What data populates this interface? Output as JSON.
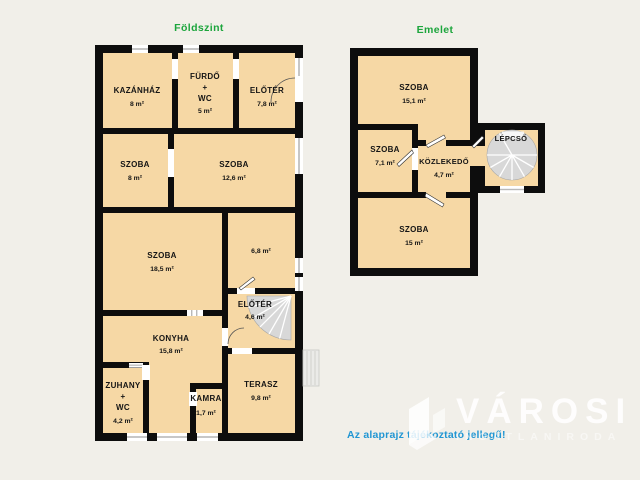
{
  "titles": {
    "ground": "Földszint",
    "upper": "Emelet"
  },
  "note": "Az alaprajz tájékoztató jellegű!",
  "watermark": {
    "brand": "VÁROSI",
    "sub": "INGATLANIRODA"
  },
  "colors": {
    "background": "#f1efe9",
    "room_fill": "#f6d8a5",
    "wall": "#0d0d0d",
    "stairs": "#d8d8d8",
    "title_green": "#1ca53c",
    "note_blue": "#2196d3",
    "watermark_white": "#ffffff"
  },
  "floors": {
    "ground": {
      "rooms": [
        {
          "name": "KAZÁNHÁZ",
          "area": "8 m²"
        },
        {
          "name": "FÜRDŐ",
          "name2": "+",
          "name3": "WC",
          "area": "5 m²"
        },
        {
          "name": "ELŐTÉR",
          "area": "7,8 m²"
        },
        {
          "name": "SZOBA",
          "area": "8 m²"
        },
        {
          "name": "SZOBA",
          "area": "12,6 m²"
        },
        {
          "name": "SZOBA",
          "area": "18,5 m²"
        },
        {
          "name": "",
          "area": "6,8 m²"
        },
        {
          "name": "ELŐTÉR",
          "area": "4,6 m²"
        },
        {
          "name": "KONYHA",
          "area": "15,8 m²"
        },
        {
          "name": "ZUHANY",
          "name2": "+",
          "name3": "WC",
          "area": "4,2 m²"
        },
        {
          "name": "KAMRA",
          "area": "1,7 m²"
        },
        {
          "name": "TERASZ",
          "area": "9,8 m²"
        }
      ]
    },
    "upper": {
      "rooms": [
        {
          "name": "SZOBA",
          "area": "15,1 m²"
        },
        {
          "name": "SZOBA",
          "area": "7,1 m²"
        },
        {
          "name": "KÖZLEKEDŐ",
          "area": "4,7 m²"
        },
        {
          "name": "LÉPCSŐ",
          "area": ""
        },
        {
          "name": "SZOBA",
          "area": "15 m²"
        }
      ]
    }
  }
}
